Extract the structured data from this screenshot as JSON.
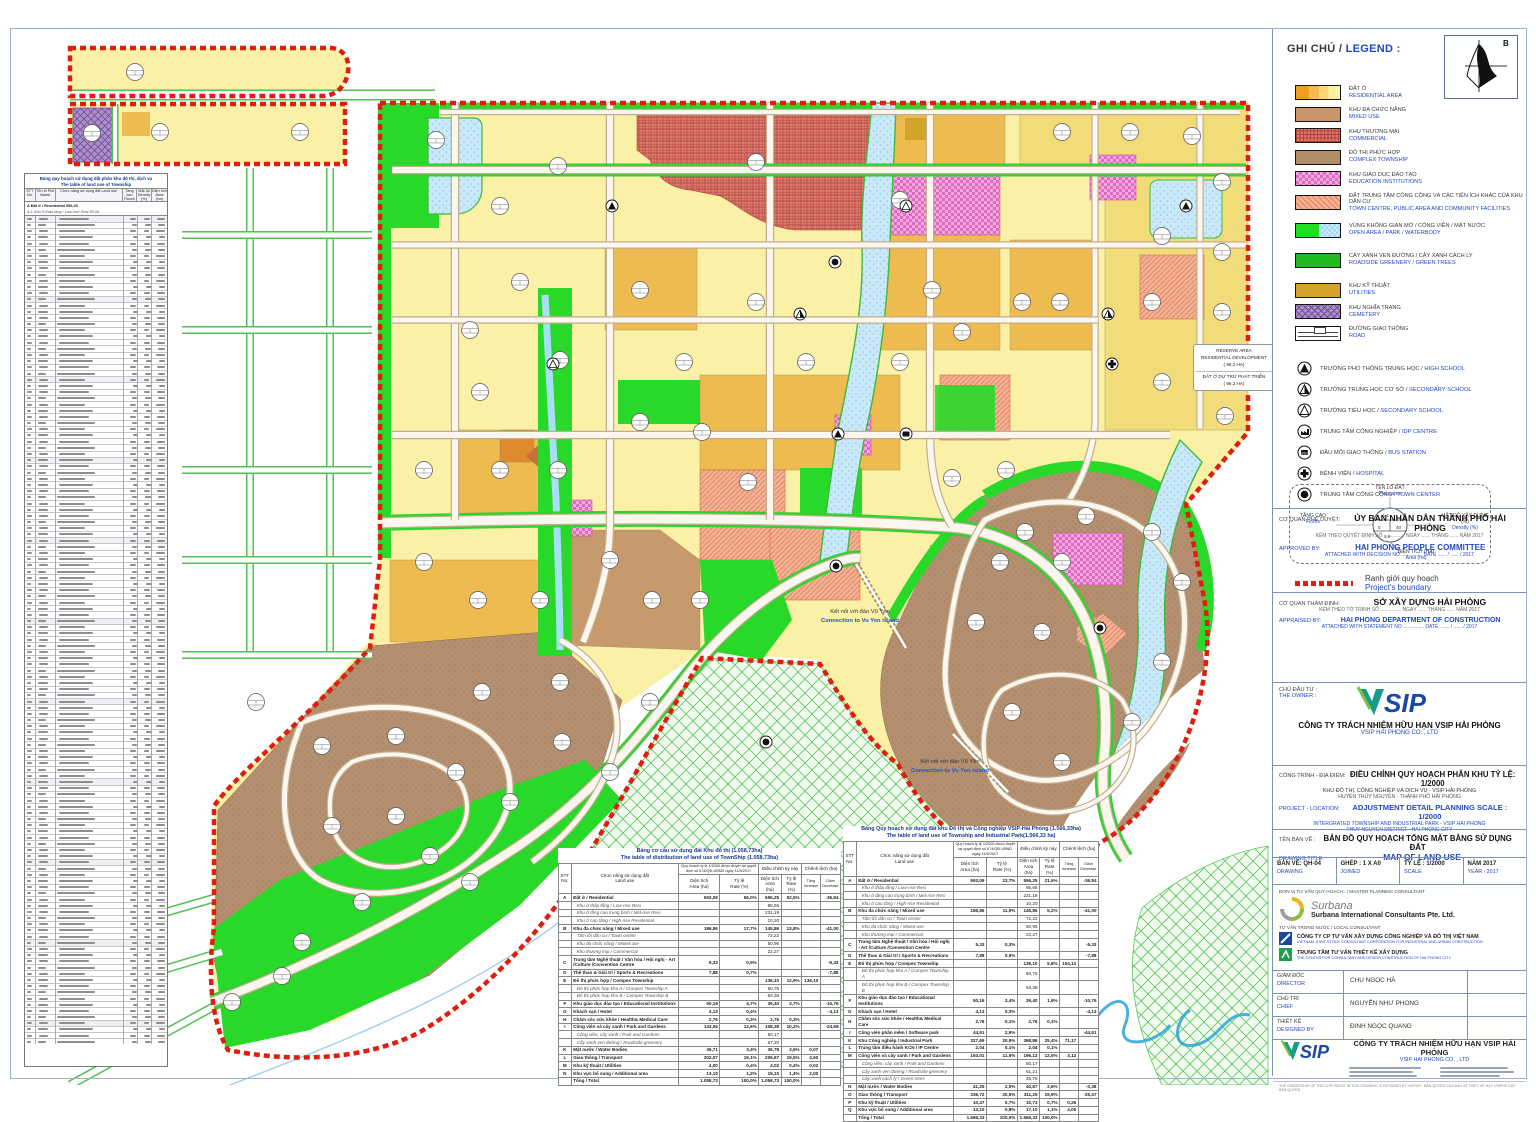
{
  "legend": {
    "title_vi": "GHI CHÚ /",
    "title_en": "LEGEND :",
    "north_label": "B",
    "items": [
      {
        "key": "res",
        "vi": "ĐẤT Ở",
        "en": "RESIDENTIAL AREA"
      },
      {
        "key": "mixed",
        "vi": "KHU ĐA CHỨC NĂNG",
        "en": "MIXED USE"
      },
      {
        "key": "com",
        "vi": "KHU THƯƠNG MẠI",
        "en": "COMMERCIAL"
      },
      {
        "key": "complex",
        "vi": "ĐÔ THỊ PHỨC HỢP",
        "en": "COMPLEX TOWNSHIP"
      },
      {
        "key": "edu",
        "vi": "KHU GIÁO DỤC ĐÀO TẠO",
        "en": "EDUCATION INSTITUTIONS"
      },
      {
        "key": "public",
        "vi": "ĐẤT TRUNG TÂM CÔNG CỘNG VÀ CÁC TIỆN ÍCH KHÁC CỦA KHU DÂN CƯ",
        "en": "TOWN CENTRE, PUBLIC AREA AND COMMUNITY FACILITIES"
      },
      {
        "key": "open",
        "vi": "VÙNG KHÔNG GIAN MỞ / CÔNG VIÊN / MẶT NƯỚC",
        "en": "OPEN AREA / PARK / WATERBODY"
      },
      {
        "key": "green",
        "vi": "CÂY XANH VEN ĐƯỜNG / CÂY XANH CÁCH LY",
        "en": "ROADSIDE GREENERY / GREEN TREES"
      },
      {
        "key": "util",
        "vi": "KHU KỸ THUẬT",
        "en": "UTILITIES"
      },
      {
        "key": "cem",
        "vi": "KHU NGHĨA TRANG",
        "en": "CEMETERY"
      },
      {
        "key": "road",
        "vi": "ĐƯỜNG GIAO THÔNG",
        "en": "ROAD"
      }
    ],
    "symbols": [
      {
        "key": "high",
        "vi": "TRƯỜNG PHỔ THÔNG TRUNG HỌC /",
        "en": "HIGH SCHOOL"
      },
      {
        "key": "sec",
        "vi": "TRƯỜNG TRUNG HỌC CƠ SỞ /",
        "en": "SECONDARY SCHOOL"
      },
      {
        "key": "pri",
        "vi": "TRƯỜNG TIỂU HỌC /",
        "en": "SECONDARY SCHOOL"
      },
      {
        "key": "idp",
        "vi": "TRUNG TÂM CÔNG NGHIỆP /",
        "en": "IDP CENTRE"
      },
      {
        "key": "bus",
        "vi": "ĐẦU MỐI GIAO THÔNG /",
        "en": "BUS STATION"
      },
      {
        "key": "hosp",
        "vi": "BỆNH VIỆN /",
        "en": "HOSPITAL"
      },
      {
        "key": "town",
        "vi": "TRUNG TÂM CÔNG CỘNG /",
        "en": "TOWN CENTER"
      }
    ],
    "plot_diagram": {
      "name_vi": "TÊN LÔ ĐẤT",
      "name_en": "Plot name",
      "floors_vi": "TẦNG CAO",
      "floors_en": "Floors",
      "density_vi": "MẬT ĐỘ XÂY DỰNG (%)",
      "density_en": "Density (%)",
      "area_vi": "DIỆN TÍCH (HA)",
      "area_en": "Area (ha)"
    },
    "boundary_vi": "Ranh giới quy hoạch",
    "boundary_en": "Project's boundary"
  },
  "approval": {
    "label_vi": "CƠ QUAN PHÊ DUYỆT:",
    "title_vi": "ỦY BAN NHÂN DÂN THÀNH PHỐ HẢI PHÒNG",
    "sub_vi": "KÈM THEO QUYẾT ĐỊNH SỐ ............... NGÀY ...... THÁNG ...... NĂM 2017",
    "label_en": "APPROVED BY:",
    "title_en": "HAI PHONG PEOPLE COMMITTEE",
    "sub_en": "ATTACHED WITH DECISION NO ...............    DATE ...... / ...... / 2017"
  },
  "appraisal": {
    "label_vi": "CƠ QUAN THẨM ĐỊNH:",
    "title_vi": "SỞ XÂY DỰNG HẢI PHÒNG",
    "sub_vi": "KÈM THEO TỜ TRÌNH SỐ ............... NGÀY ...... THÁNG ...... NĂM 2017",
    "label_en": "APPRAISED BY:",
    "title_en": "HAI PHONG DEPARTMENT OF CONSTRUCTION",
    "sub_en": "ATTACHED WITH STATEMENT NO ...............    DATE: ...... / ...... / 2017"
  },
  "owner": {
    "label_vi": "CHỦ ĐẦU TƯ :",
    "label_en": "THE OWNER :",
    "logo": "VSIP",
    "name_vi": "CÔNG TY TRÁCH NHIỆM HỮU HẠN VSIP HẢI PHÒNG",
    "name_en": "VSIP HAI PHONG CO. , LTD"
  },
  "project": {
    "label_vi": "CÔNG TRÌNH - ĐỊA ĐIỂM:",
    "label_en": "PROJECT - LOCATION:",
    "title_vi": "ĐIỀU CHỈNH QUY HOẠCH PHÂN KHU TỶ LỆ: 1/2000",
    "sub1_vi": "KHU ĐÔ THỊ, CÔNG NGHIỆP VÀ DỊCH VỤ - VSIP HẢI PHÒNG",
    "sub2_vi": "HUYỆN THỦY NGUYÊN - THÀNH PHỐ HẢI PHÒNG",
    "title_en": "ADJUSTMENT DETAIL PLANNING SCALE : 1/2000",
    "sub1_en": "INTERGRATED TOWNSHIP AND INDUSTRIAL PARK - VSIP HAI PHONG",
    "sub2_en": "THUY NGUYEN DISTRICT - HAI PHONG CITY"
  },
  "drawing": {
    "label_vi": "TÊN BẢN VẼ :",
    "label_en": "DRAWING TITLE:",
    "title_vi": "BẢN ĐỒ QUY HOẠCH TỔNG MẶT BẰNG SỬ DỤNG ĐẤT",
    "title_en": "MAP OF LAND USE",
    "cells": [
      {
        "b": "BẢN VẼ: QH-04",
        "s": "DRAWING"
      },
      {
        "b": "GHÉP :  1 X A0",
        "s": "JOINED"
      },
      {
        "b": "TỶ LỆ :  1/2000",
        "s": "SCALE"
      },
      {
        "b": "NĂM 2017",
        "s": "YEAR : 2017"
      }
    ]
  },
  "consultant": {
    "section_label": "ĐƠN VỊ TƯ VẤN QUY HOẠCH :  / MASTER PLANNING CONSULTANT",
    "surbana_script": "Surbana",
    "surbana_name": "Surbana International Consultants Pte. Ltd.",
    "local_label": "TƯ VẤN TRONG NƯỚC / LOCAL CONSULTANT",
    "local1_vi": "CÔNG TY CP TƯ VẤN XÂY DỰNG CÔNG NGHIỆP VÀ ĐÔ THỊ VIỆT NAM",
    "local1_en": "VIETNAM JOINT-STOCK CONSULTANT CORPORATION FOR INDUSTRIAL AND URBAN CONSTRUCTION",
    "local2_vi": "TRUNG TÂM TƯ VẤN THIẾT KẾ XÂY DỰNG",
    "local2_en": "THE CENTER FOR CONSULTANT AND DESIGN CONSTRUCTION OF HAI PHONG CITY",
    "signatures": [
      {
        "vi": "GIÁM ĐỐC",
        "en": "DIRECTOR",
        "name": "CHU NGỌC HÀ"
      },
      {
        "vi": "CHỦ TRÌ",
        "en": "CHIEF",
        "name": "NGUYỄN NHƯ PHONG"
      },
      {
        "vi": "THIẾT KẾ",
        "en": "DESIGNED BY",
        "name": "ĐINH NGỌC QUANG"
      }
    ],
    "footer_logo": "VSIP",
    "footer_vi": "CÔNG TY TRÁCH NHIỆM HỮU HẠN VSIP HẢI PHÒNG",
    "footer_en": "VSIP HAI PHONG CO. , LTD",
    "copyright": "THE OWNERSHIP OF THE COPYRIGHT IN THIS DRAWING IS RETAINED BY VSIPHP  -  BẢN QUYỀN CỦA BẢN VẼ THIẾT KẾ NÀY VSIPHP GIỮ BẢN QUYỀN"
  },
  "map_labels": {
    "connection1_vi": "Kết nối với đảo Vũ Yên",
    "connection1_en": "Connection to Vu Yen island",
    "connection2_vi": "Kết nối với đảo Vũ Yên",
    "connection2_en": "Connection to Vu Yen island",
    "reserve_l1": "RESERVE AREA",
    "reserve_l2": "RESIDENTIAL DEVELOPMENT",
    "reserve_l3": "( 86.2 HA)",
    "reserve_l4": "ĐẤT Ở DỰ TRỮ PHÁT TRIỂN",
    "reserve_l5": "( 86.2 HA)"
  },
  "left_table": {
    "title_vi": "Bảng quy hoạch sử dụng đất phân khu đô thị, dịch vụ",
    "title_en": "The table of land use of Township",
    "head": [
      "STT\nNo.",
      "Tên lô\nPlot Name",
      "Chức năng sử dụng đất\nLand use",
      "Tầng cao\nFloors",
      "Mật độ\nDensity (%)",
      "Diện tích\nArea (ha)"
    ],
    "row_a": "A   Đất ở / Residential                                           556,25",
    "row_a1": "A.1   Khu ở thấp tầng / Low-rise Resi                    85,66"
  },
  "mid_table": {
    "title_vi": "Bảng cơ cấu sử dụng đất Khu đô thị (1.058,73ha)",
    "title_en": "The table of distribution of land use of TownShip (1.058,73ha)",
    "h_no": "STT\nNo.",
    "h_use": "Chức năng sử dụng đất\nLand use",
    "h_plan": "Quy hoạch tỷ lệ 1/2000 được duyệt tại quyết định số 674/QĐ-UBND ngày 11/5/2017",
    "h_adj": "Điều chỉnh kỳ này",
    "h_diff": "Chênh lệch (ha)",
    "h_area": "Diện tích\nArea (ha)",
    "h_rate": "Tỷ lệ\nRate (%)",
    "h_inc": "Tăng\nIncrease",
    "h_dec": "Giảm\nDecrease",
    "rows": [
      [
        "A",
        "Đất ở / Residential",
        "593,09",
        "56,0%",
        "556,25",
        "52,5%",
        "",
        "-36,84",
        "sect"
      ],
      [
        "",
        "Khu ở thấp tầng / Low-rise Resi",
        "",
        "",
        "85,66",
        "",
        "",
        "",
        "sub"
      ],
      [
        "",
        "Khu ở tầng cao trung bình / Mid-rise Resi",
        "",
        "",
        "231,19",
        "",
        "",
        "",
        "sub"
      ],
      [
        "",
        "Khu ở cao tầng / High-rise Residential",
        "",
        "",
        "10,20",
        "",
        "",
        "",
        "sub"
      ],
      [
        "B",
        "Khu đa chức năng / Mixed use",
        "186,86",
        "17,7%",
        "145,86",
        "13,8%",
        "",
        "-41,00",
        "sect"
      ],
      [
        "",
        "Tâm lõi dân cư / Town center",
        "",
        "",
        "72,22",
        "",
        "",
        "",
        "sub"
      ],
      [
        "",
        "Khu đa chức năng / Mixed use",
        "",
        "",
        "50,95",
        "",
        "",
        "",
        "sub"
      ],
      [
        "",
        "Khu thương mại / Commercial",
        "",
        "",
        "22,27",
        "",
        "",
        "",
        "sub"
      ],
      [
        "C",
        "Trung tâm Nghệ thuật / Văn hóa / Hội nghị - Art /Culture /Convention Centre",
        "5,33",
        "0,5%",
        "",
        "",
        "",
        "-5,33",
        "sect"
      ],
      [
        "D",
        "Thể thao & Giải trí / Sports & Recreations",
        "7,88",
        "0,7%",
        "",
        "",
        "",
        "-7,88",
        "sect"
      ],
      [
        "E",
        "Đô thị phức hợp / Compex Township",
        "",
        "",
        "136,10",
        "12,9%",
        "136,10",
        "",
        "sect"
      ],
      [
        "",
        "Đô thị phức hợp khu A / Compex Township A",
        "",
        "",
        "50,75",
        "",
        "",
        "",
        "sub"
      ],
      [
        "",
        "Đô thị phức hợp khu B / Compex Township B",
        "",
        "",
        "83,38",
        "",
        "",
        "",
        "sub"
      ],
      [
        "F",
        "Khu giáo dục đào tạo / Educational Institutions",
        "50,16",
        "4,7%",
        "39,40",
        "3,7%",
        "",
        "-10,76",
        "sect"
      ],
      [
        "G",
        "Khách sạn / Hotel",
        "4,13",
        "0,4%",
        "",
        "",
        "",
        "-4,13",
        "sect"
      ],
      [
        "H",
        "Chăm sóc sức khỏe / Health& Medical Care",
        "2,76",
        "0,3%",
        "2,76",
        "0,3%",
        "",
        "",
        "sect"
      ],
      [
        "I",
        "Công viên và cây xanh / Park and Gardens",
        "133,06",
        "12,6%",
        "108,38",
        "10,2%",
        "",
        "-24,68",
        "sect"
      ],
      [
        "",
        "Công viên, cây xanh / Park and Gardens",
        "",
        "",
        "50,17",
        "",
        "",
        "",
        "sub"
      ],
      [
        "",
        "Cây xanh ven đường / Roadside greenery",
        "",
        "",
        "67,20",
        "",
        "",
        "",
        "sub"
      ],
      [
        "K",
        "Mặt nước / Water Bodies",
        "36,71",
        "3,4%",
        "36,78",
        "3,5%",
        "0,07",
        "",
        "sect"
      ],
      [
        "L",
        "Giao thông / Transport",
        "202,07",
        "19,1%",
        "206,67",
        "19,5%",
        "4,60",
        "",
        "sect"
      ],
      [
        "M",
        "Khu kỹ thuật / Utilities",
        "4,00",
        "0,4%",
        "4,02",
        "0,4%",
        "0,02",
        "",
        "sect"
      ],
      [
        "N",
        "Khu vực bổ sung / Additional area",
        "13,10",
        "1,2%",
        "15,10",
        "1,4%",
        "2,00",
        "",
        "sect"
      ],
      [
        "",
        "Tổng / Total",
        "1.058,73",
        "100,0%",
        "1.058,73",
        "100,0%",
        "",
        "",
        "sect"
      ]
    ]
  },
  "right_table": {
    "title_vi": "Bảng Quy hoạch sử dụng đất khu Đô thị và Công nghiệp VSIP-Hải Phòng (1.566,33ha)",
    "title_en": "The table of land use of Township and Industrial Park(1.566,33 ha)",
    "h_no": "STT\nNo.",
    "h_use": "Chức năng sử dụng đất\nLand use",
    "h_plan": "Quy hoạch tỷ lệ 1/2000 được duyệt tại quyết định số 674/QĐ-UBND ngày 11/5/2017",
    "h_adj": "Điều chỉnh kỳ này",
    "h_diff": "Chênh lệch (ha)",
    "h_area": "Diện tích\nArea (ha)",
    "h_rate": "Tỷ lệ\nRate (%)",
    "h_inc": "Tăng\nIncrease",
    "h_dec": "Giảm\nDecrease",
    "rows": [
      [
        "A",
        "Đất ở / Residential",
        "593,09",
        "23,7%",
        "556,25",
        "21,5%",
        "",
        "-36,84",
        "sect"
      ],
      [
        "",
        "Khu ở thấp tầng / Low-rise Resi",
        "",
        "",
        "85,66",
        "",
        "",
        "",
        "sub"
      ],
      [
        "",
        "Khu ở tầng cao trung bình / Mid-rise Resi",
        "",
        "",
        "231,19",
        "",
        "",
        "",
        "sub"
      ],
      [
        "",
        "Khu ở cao tầng / High-rise Residential",
        "",
        "",
        "10,20",
        "",
        "",
        "",
        "sub"
      ],
      [
        "B",
        "Khu đa chức năng / Mixed use",
        "186,86",
        "11,9%",
        "145,86",
        "5,2%",
        "",
        "-41,00",
        "sect"
      ],
      [
        "",
        "Tâm lõi dân cư / Town center",
        "",
        "",
        "72,22",
        "",
        "",
        "",
        "sub"
      ],
      [
        "",
        "Khu đa chức năng / Mixed use",
        "",
        "",
        "50,95",
        "",
        "",
        "",
        "sub"
      ],
      [
        "",
        "Khu thương mại / Commercial",
        "",
        "",
        "22,27",
        "",
        "",
        "",
        "sub"
      ],
      [
        "C",
        "Trung tâm Nghệ thuật / Văn hóa / Hội nghị - Art /Culture /Convention Centre",
        "5,33",
        "0,3%",
        "",
        "",
        "",
        "-5,33",
        "sect"
      ],
      [
        "D",
        "Thể thao & Giải trí / Sports & Recreations",
        "7,88",
        "0,5%",
        "",
        "",
        "",
        "-7,88",
        "sect"
      ],
      [
        "E",
        "Đô thị phức hợp / Compex Township",
        "",
        "",
        "136,10",
        "5,8%",
        "104,12",
        "",
        "sect"
      ],
      [
        "",
        "Đô thị phức hợp khu A / Compex Township A",
        "",
        "",
        "50,75",
        "",
        "",
        "",
        "sub"
      ],
      [
        "",
        "Đô thị phức hợp khu B / Compex Township B",
        "",
        "",
        "83,38",
        "",
        "",
        "",
        "sub"
      ],
      [
        "F",
        "Khu giáo dục đào tạo / Educational Institutions",
        "50,16",
        "3,4%",
        "39,40",
        "1,9%",
        "",
        "-10,76",
        "sect"
      ],
      [
        "G",
        "Khách sạn / Hotel",
        "4,13",
        "0,3%",
        "",
        "",
        "",
        "-4,13",
        "sect"
      ],
      [
        "H",
        "Chăm sóc sức khỏe / Health& Medical Care",
        "2,76",
        "0,1%",
        "2,76",
        "0,1%",
        "",
        "",
        "sect"
      ],
      [
        "I",
        "Công viên phần mềm / Software park",
        "44,61",
        "2,9%",
        "",
        "",
        "",
        "-44,61",
        "sect"
      ],
      [
        "K",
        "Khu Công nghiệp / Industrial Park",
        "327,69",
        "20,9%",
        "398,86",
        "25,4%",
        "71,17",
        "",
        "sect"
      ],
      [
        "L",
        "Trung tâm điều hành KCN / IP Centre",
        "2,04",
        "0,1%",
        "2,04",
        "0,1%",
        "",
        "",
        "sect"
      ],
      [
        "M",
        "Công viên và cây xanh / Park and Gardens",
        "193,01",
        "11,5%",
        "196,13",
        "12,5%",
        "3,12",
        "",
        "sect"
      ],
      [
        "",
        "Công viên, cây xanh / Park and Gardens",
        "",
        "",
        "50,17",
        "",
        "",
        "",
        "sub"
      ],
      [
        "",
        "Cây xanh ven đường / Roadside greenery",
        "",
        "",
        "61,21",
        "",
        "",
        "",
        "sub"
      ],
      [
        "",
        "Cây xanh cách ly / Green trees",
        "",
        "",
        "48,75",
        "",
        "",
        "",
        "sub"
      ],
      [
        "N",
        "Mặt nước / Water Bodies",
        "41,25",
        "2,5%",
        "40,87",
        "2,6%",
        "",
        "-0,38",
        "sect"
      ],
      [
        "O",
        "Giao thông / Transport",
        "336,72",
        "20,5%",
        "311,25",
        "19,9%",
        "",
        "-25,47",
        "sect"
      ],
      [
        "P",
        "Khu kỹ thuật / Utilities",
        "10,47",
        "0,7%",
        "10,73",
        "0,7%",
        "0,26",
        "",
        "sect"
      ],
      [
        "Q",
        "Khu vực bổ sung / Additional area",
        "13,10",
        "0,8%",
        "17,10",
        "1,1%",
        "4,00",
        "",
        "sect"
      ],
      [
        "",
        "Tổng / Total",
        "1.566,33",
        "100,0%",
        "1.566,33",
        "100,0%",
        "",
        "",
        "sect"
      ]
    ]
  },
  "colors": {
    "boundary": "#DE1F10",
    "residential": "#FCF3A2",
    "mid_yellow": "#F2DC7A",
    "ochre": "#EDBB4F",
    "mixed": "#C79A6E",
    "complex": "#B59070",
    "commercial": "#DD7A6E",
    "education": "#F3A8DF",
    "public": "#F5B194",
    "open_green": "#29D929",
    "greenery": "#1FBB1F",
    "water": "#C9E9F8",
    "utilities": "#D2A429",
    "cemetery": "#AE8FCB",
    "english_text": "#2148C0"
  }
}
